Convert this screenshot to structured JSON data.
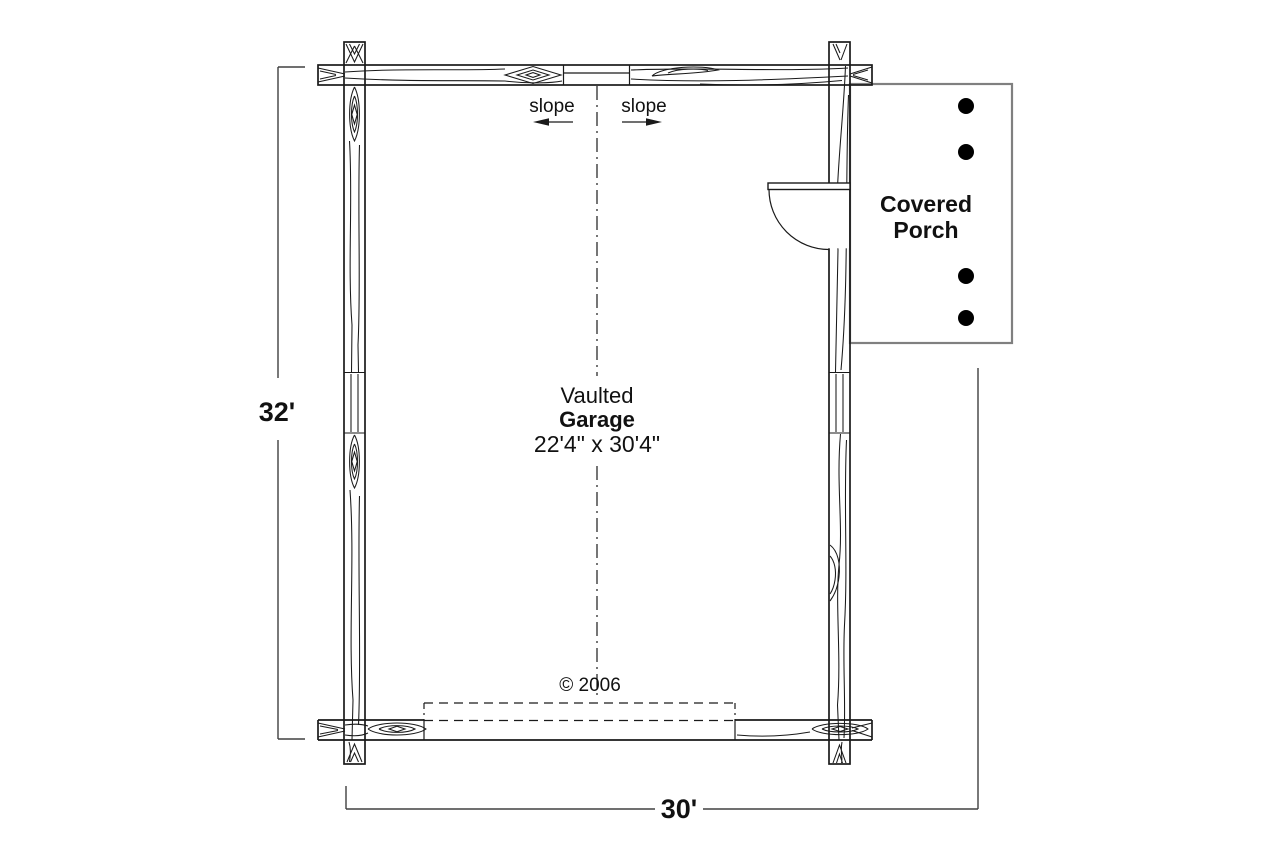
{
  "labels": {
    "slope_left": "slope",
    "slope_right": "slope",
    "room_name_line1": "Vaulted",
    "room_name_line2": "Garage",
    "room_dimensions": "22'4\" x 30'4\"",
    "porch_line1": "Covered",
    "porch_line2": "Porch",
    "copyright": "© 2006",
    "dim_left": "32'",
    "dim_bottom": "30'"
  },
  "colors": {
    "background": "#ffffff",
    "wall_line": "#1a1a1a",
    "dimension_line": "#404040",
    "porch_border": "#808080",
    "post_fill": "#000000"
  }
}
